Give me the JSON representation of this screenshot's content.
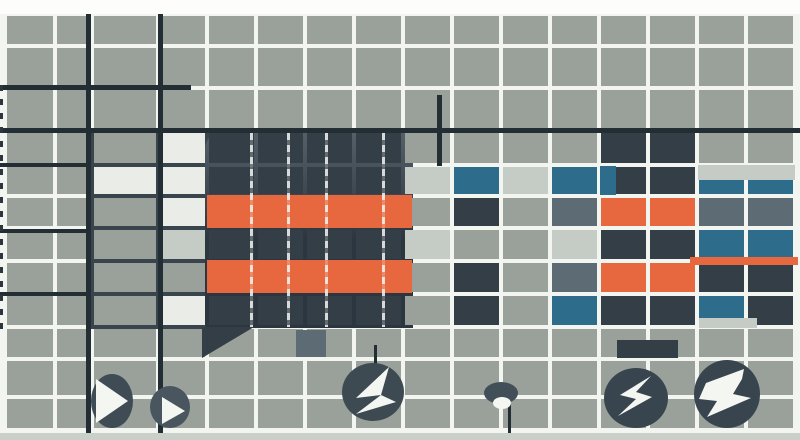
{
  "canvas": {
    "width": 800,
    "height": 440
  },
  "palette": {
    "page_bg": "#f3f5f1",
    "top_strip": "#fdfefc",
    "bottom_strip": "#c9cfc9",
    "G": "#9aa19a",
    "L": "#c5cbc5",
    "W": "#eaece8",
    "D": "#333e47",
    "S": "#5c6b74",
    "T": "#2d6c8b",
    "O": "#e7683e",
    "rule": "#232d34",
    "left_dark": "#39444c",
    "block_hi": "#556069",
    "block_lo": "#2b3640",
    "glyph": "#f4f6f2"
  },
  "grid": {
    "col_edges": [
      5,
      55,
      92,
      158,
      207,
      256,
      305,
      354,
      403,
      452,
      501,
      550,
      599,
      648,
      697,
      746,
      795
    ],
    "row_edges": [
      14,
      46,
      88,
      131,
      165,
      196,
      228,
      261,
      294,
      327,
      359,
      397,
      430
    ],
    "gap": 2,
    "rows": [
      "GGGGGGGGGGGGGGGG",
      "GGGGGGGGGGGGGGGG",
      "GGGGGGGGGGGGGGGG",
      "GGGWDDDDGGGGDDGG",
      "GGWWDDDDLTLTDDTT",
      "GGGWDDDDGDGSOOSS",
      "GGGLDDDDLGGLDDTT",
      "GGGGDDDDGDGSOODD",
      "GGGWDDDDGDGTDDTD",
      "GGGGGGGGGGGGGGGG",
      "GGGGGGGGGGGGGGGG",
      "GGGGGGGGGGGGGGGG"
    ]
  },
  "underlays": [
    {
      "name": "left-dark-grid-region",
      "x": 86,
      "y": 129,
      "w": 124,
      "h": 200,
      "k": "left_dark"
    },
    {
      "name": "dark-block",
      "x": 205,
      "y": 131,
      "w": 208,
      "h": 197,
      "k": "block_lo",
      "gradient": true,
      "radius": "18px 4px 0 4px"
    }
  ],
  "overlays": [
    {
      "name": "orange-stripe-top",
      "x": 207,
      "y": 195,
      "w": 205,
      "h": 33,
      "k": "O"
    },
    {
      "name": "orange-stripe-bottom",
      "x": 207,
      "y": 260,
      "w": 205,
      "h": 33,
      "k": "O"
    },
    {
      "name": "light-strip-right-top",
      "x": 698,
      "y": 165,
      "w": 97,
      "h": 15,
      "k": "L"
    },
    {
      "name": "orange-thin-strip-right",
      "x": 690,
      "y": 257,
      "w": 108,
      "h": 8,
      "k": "O"
    },
    {
      "name": "light-strip-right-bottom",
      "x": 699,
      "y": 318,
      "w": 58,
      "h": 10,
      "k": "L"
    },
    {
      "name": "dark-tile-above-badge",
      "x": 617,
      "y": 340,
      "w": 61,
      "h": 18,
      "k": "D"
    },
    {
      "name": "slate-tile-below-block",
      "x": 296,
      "y": 330,
      "w": 30,
      "h": 27,
      "k": "S"
    },
    {
      "name": "teal-sliver",
      "x": 600,
      "y": 166,
      "w": 16,
      "h": 29,
      "k": "T"
    },
    {
      "name": "dark-wedge",
      "x": 202,
      "y": 327,
      "w": 52,
      "h": 31,
      "k": "D",
      "clip": "polygon(0 0, 100% 0, 0 100%)"
    },
    {
      "name": "top-strip",
      "x": 0,
      "y": 0,
      "w": 800,
      "h": 14,
      "k": "top_strip"
    },
    {
      "name": "bottom-strip",
      "x": 0,
      "y": 433,
      "w": 800,
      "h": 7,
      "k": "bottom_strip"
    }
  ],
  "rules": [
    {
      "name": "vertical-rule-left",
      "x": 86,
      "y": 14,
      "w": 5,
      "h": 419
    },
    {
      "name": "vertical-rule-mid",
      "x": 158,
      "y": 14,
      "w": 5,
      "h": 419
    },
    {
      "name": "horizontal-rule-upper-left",
      "x": 0,
      "y": 85,
      "w": 191,
      "h": 5
    },
    {
      "name": "horizontal-rule-full",
      "x": 0,
      "y": 128,
      "w": 800,
      "h": 5
    },
    {
      "name": "vertical-segment-center",
      "x": 437,
      "y": 95,
      "w": 5,
      "h": 71
    },
    {
      "name": "vertical-segment-above-badge",
      "x": 374,
      "y": 345,
      "w": 3,
      "h": 23
    },
    {
      "name": "stem-below-dome",
      "x": 508,
      "y": 402,
      "w": 3,
      "h": 31
    },
    {
      "name": "left-band-dark-line-1",
      "x": 0,
      "y": 163,
      "w": 90,
      "h": 4
    },
    {
      "name": "left-band-dark-line-2",
      "x": 0,
      "y": 229,
      "w": 88,
      "h": 4
    },
    {
      "name": "left-band-dark-line-3",
      "x": 0,
      "y": 292,
      "w": 88,
      "h": 4
    }
  ],
  "block_lines": {
    "xs": [
      250,
      287,
      325,
      382
    ],
    "y": 133,
    "h": 194,
    "w": 3
  },
  "left_edge_dashes": {
    "x": 0,
    "y": 85,
    "w": 3,
    "h": 245
  },
  "badges": [
    {
      "name": "play-badge-large",
      "fill": "#3f4c55",
      "cx": 112,
      "cy": 401,
      "rx": 21,
      "ry": 27,
      "glyphs": [
        {
          "type": "polygon",
          "points": "96,379 96,423 128,401"
        }
      ]
    },
    {
      "name": "play-badge-small",
      "fill": "#4a565f",
      "cx": 170,
      "cy": 407,
      "rx": 20,
      "ry": 21,
      "glyphs": [
        {
          "type": "polygon",
          "points": "162,397 162,424 185,411"
        }
      ]
    },
    {
      "name": "fold-arrow-badge",
      "fill": "#3d4a52",
      "cx": 373,
      "cy": 392,
      "rx": 31,
      "ry": 29,
      "glyphs": [
        {
          "type": "polygon",
          "points": "389,367 356,398 381,395"
        },
        {
          "type": "polygon",
          "points": "381,395 396,402 356,414"
        }
      ]
    },
    {
      "name": "dome-badge",
      "fill": "#434f58",
      "cx": 501,
      "cy": 393,
      "rx": 17,
      "ry": 11,
      "glyphs": [
        {
          "type": "ellipse",
          "cx": 502,
          "cy": 403,
          "rx": 9,
          "ry": 6
        }
      ]
    },
    {
      "name": "bolt-badge",
      "fill": "#39454e",
      "cx": 636,
      "cy": 398,
      "rx": 32,
      "ry": 30,
      "glyphs": [
        {
          "type": "polygon",
          "points": "651,376 620,395 636,399 618,416 652,397 636,392"
        }
      ]
    },
    {
      "name": "double-bolt-badge",
      "fill": "#39454e",
      "cx": 727,
      "cy": 394,
      "rx": 33,
      "ry": 34,
      "glyphs": [
        {
          "type": "polygon",
          "points": "744,369 706,383 699,399 717,401 707,417 751,398 733,394 742,379"
        }
      ]
    }
  ]
}
